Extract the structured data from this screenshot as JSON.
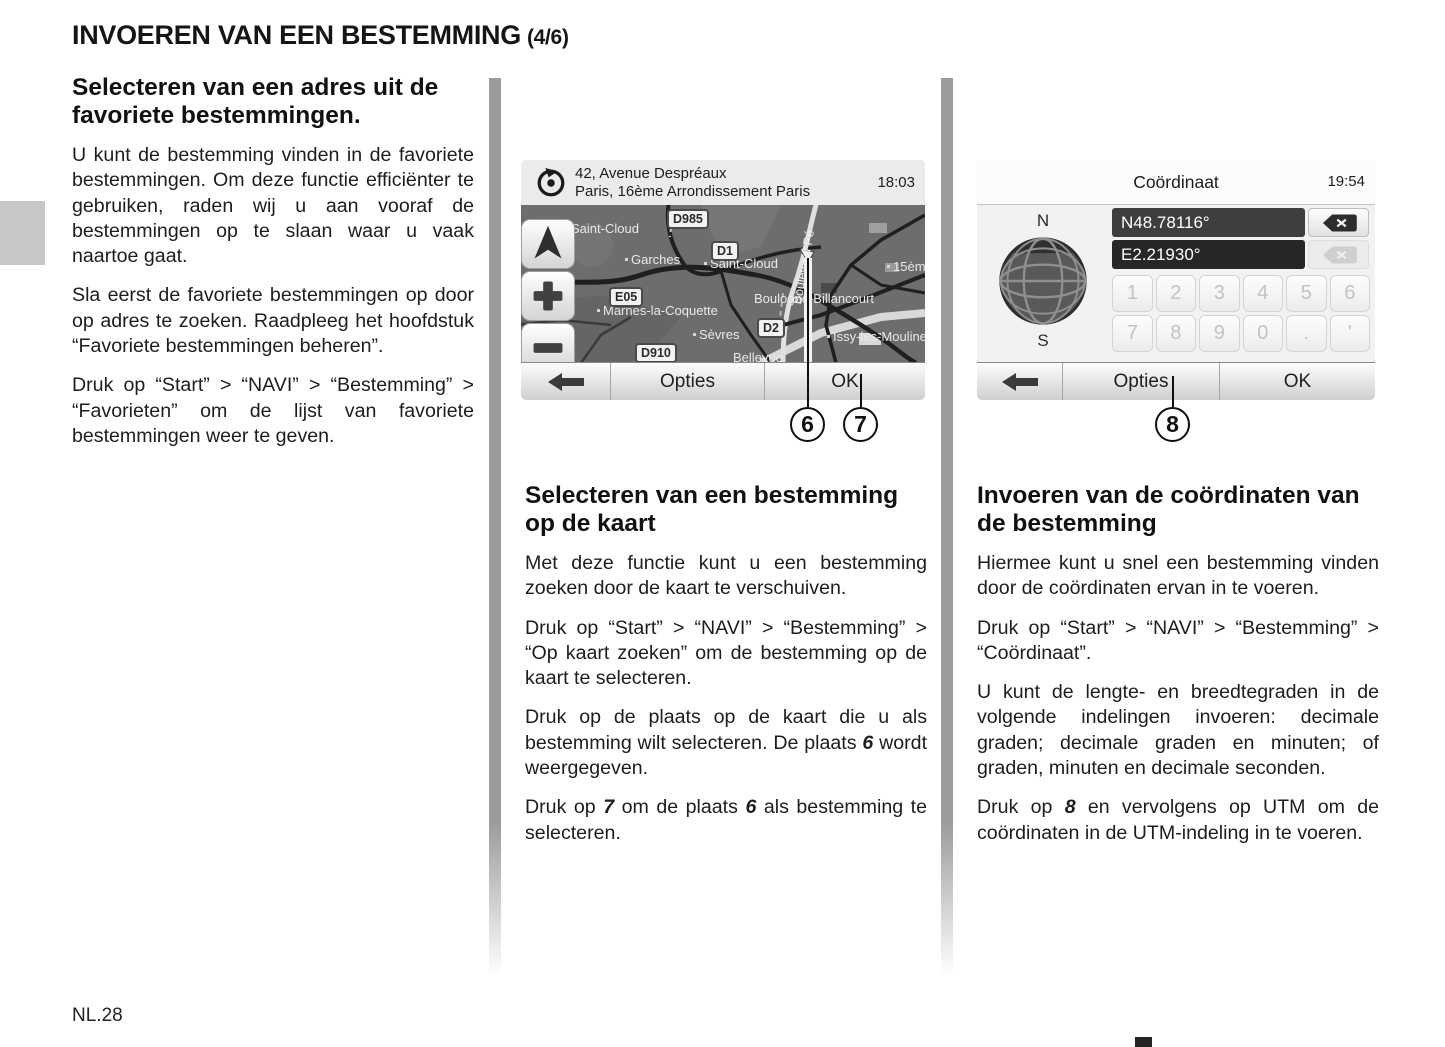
{
  "page": {
    "title_main": "INVOEREN VAN EEN BESTEMMING",
    "title_suffix": "(4/6)",
    "page_number": "NL.28"
  },
  "left_column": {
    "heading": "Selecteren van een adres uit de favoriete bestemmingen.",
    "p1": "U kunt de bestemming vinden in de favoriete bestemmingen. Om deze functie efficiënter te gebruiken, raden wij u aan vooraf de bestemmingen op te slaan waar u vaak naartoe gaat.",
    "p2": "Sla eerst de favoriete bestemmingen op door op adres te zoeken. Raadpleeg het hoofdstuk “Favoriete bestemmingen beheren”.",
    "p3": "Druk op “Start” > “NAVI” > “Bestemming” > “Favorieten” om de lijst van favoriete bestemmingen weer te geven."
  },
  "middle_column": {
    "heading": "Selecteren van een bestemming op de kaart",
    "p1": "Met deze functie kunt u een bestemming zoeken door de kaart te verschuiven.",
    "p2": "Druk op “Start” > “NAVI” > “Bestemming” > “Op kaart zoeken” om de bestemming op de kaart te selecteren.",
    "p3_a": "Druk op de plaats op de kaart die u als bestemming wilt selecteren. De plaats ",
    "p3_ref": "6",
    "p3_b": " wordt weergegeven.",
    "p4_a": "Druk op ",
    "p4_ref1": "7",
    "p4_b": " om de plaats ",
    "p4_ref2": "6",
    "p4_c": " als bestemming te selecteren."
  },
  "right_column": {
    "heading": "Invoeren van de coördinaten van de bestemming",
    "p1": "Hiermee kunt u snel een bestemming vinden door de coördinaten ervan in te voeren.",
    "p2": "Druk op “Start” > “NAVI” > “Bestemming” > “Coördinaat”.",
    "p3": "U kunt de lengte- en breedtegraden in de volgende indelingen invoeren: decimale graden; decimale graden en minuten; of graden, minuten en decimale seconden.",
    "p4_a": "Druk op ",
    "p4_ref": "8",
    "p4_b": " en vervolgens op UTM om de coördinaten in de UTM-indeling in te voeren."
  },
  "map_screen": {
    "header": {
      "address_line1": "42, Avenue Despréaux",
      "address_line2": "Paris, 16ème Arrondissement Paris",
      "time": "18:03"
    },
    "road_shields": [
      "D985",
      "D1",
      "E05",
      "D2",
      "D910"
    ],
    "places": {
      "saint_cloud_nw": "Saint-Cloud",
      "garches": "Garches",
      "saint_cloud_c": "Saint-Cloud",
      "marnes": "Marnes-la-Coquette",
      "sevres": "Sèvres",
      "boulogne_billancourt": "Boulogne-Billancourt",
      "issy": "Issy-les-Moulinea",
      "bellevue": "Bellevue",
      "arr15": "15èm",
      "boulevard": "Boulevard Pé"
    },
    "footer": {
      "options": "Opties",
      "ok": "OK"
    }
  },
  "coord_screen": {
    "title": "Coördinaat",
    "time": "19:54",
    "north": "N",
    "south": "S",
    "latitude": "N48.78116°",
    "longitude": "E2.21930°",
    "keys_row1": [
      "1",
      "2",
      "3",
      "4",
      "5",
      "6"
    ],
    "keys_row2": [
      "7",
      "8",
      "9",
      "0",
      ".",
      "'"
    ],
    "footer": {
      "options": "Opties",
      "ok": "OK"
    }
  },
  "callouts": {
    "c6": "6",
    "c7": "7",
    "c8": "8"
  }
}
